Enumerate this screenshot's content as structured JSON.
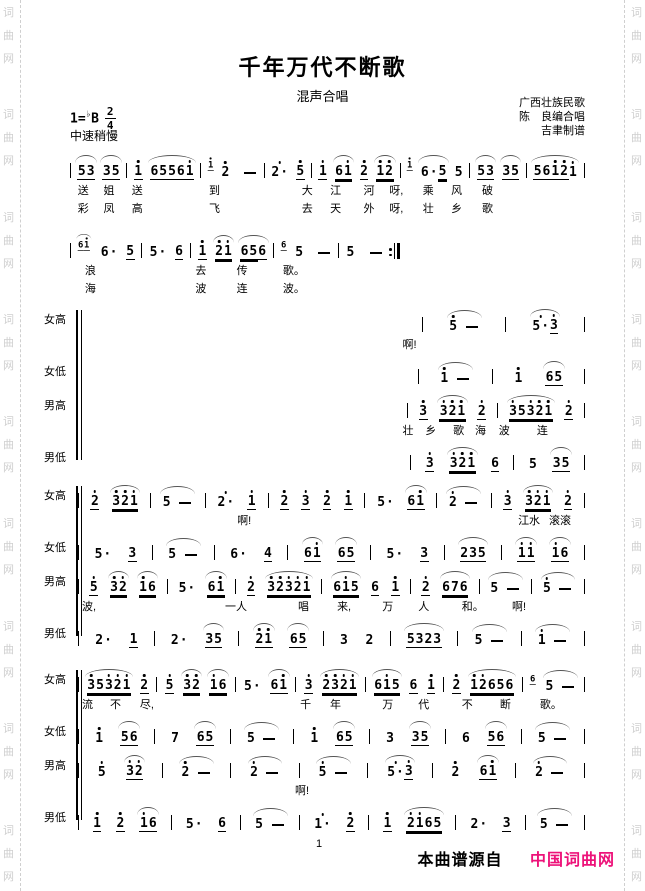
{
  "header": {
    "title": "千年万代不断歌",
    "subtitle": "混声合唱",
    "key_prefix": "1=",
    "key_flat": "♭",
    "key_note": "B",
    "meter_num": "2",
    "meter_den": "4",
    "tempo": "中速稍慢",
    "credits": [
      "广西壮族民歌",
      "陈　良编合唱",
      "吉聿制谱"
    ]
  },
  "watermark": {
    "chars": [
      "词",
      "曲",
      "网"
    ],
    "color": "#cfcfcf",
    "groups": 9
  },
  "music": {
    "systems": [
      {
        "id": "system-1",
        "type": "plain",
        "top": 146,
        "left": 70,
        "width": 515,
        "rows": [
          {
            "notes": "| 5_3_ 3_5_ | 1'_ 6_5_5_6_1'_ | (1'_) 2' - | 2'* 5'_ | 1'_ 6=1'= 2'_ 1'=2'= | (1'_) 6*5= 5 | 5_3_ 3_5_ | 5_6_1'_2'_1' |"
          },
          {
            "words": [
              [
                "送",
                1.5
              ],
              [
                "姐",
                6.5
              ],
              [
                "送",
                12
              ],
              [
                "到",
                27
              ],
              [
                "大",
                45
              ],
              [
                "江",
                50.5
              ],
              [
                "河",
                57
              ],
              [
                "呀,",
                62
              ],
              [
                "乘",
                68.5
              ],
              [
                "风",
                74
              ],
              [
                "破",
                80
              ]
            ]
          },
          {
            "words": [
              [
                "彩",
                1.5
              ],
              [
                "凤",
                6.5
              ],
              [
                "高",
                12
              ],
              [
                "飞",
                27
              ],
              [
                "去",
                45
              ],
              [
                "天",
                50.5
              ],
              [
                "外",
                57
              ],
              [
                "呀,",
                62
              ],
              [
                "壮",
                68.5
              ],
              [
                "乡",
                74
              ],
              [
                "歌",
                80
              ]
            ]
          }
        ]
      },
      {
        "id": "system-2",
        "type": "plain",
        "top": 226,
        "left": 70,
        "width": 330,
        "rows": [
          {
            "notes": "| (6_1'_) 6* 5_ | 5* 6_ | 1'_ 2'=1'= 6=5=6_ | (6_) 5 - | 5 - :|"
          },
          {
            "words": [
              [
                "浪",
                4.5
              ],
              [
                "去",
                38
              ],
              [
                "传",
                50.5
              ],
              [
                "歌。",
                64.5
              ]
            ]
          },
          {
            "words": [
              [
                "海",
                4.5
              ],
              [
                "波",
                38
              ],
              [
                "连",
                50.5
              ],
              [
                "波。",
                64.5
              ]
            ]
          }
        ]
      },
      {
        "id": "system-3",
        "type": "choral",
        "top": 300,
        "left": 44,
        "width": 541,
        "rows": [
          {
            "label": "女高",
            "notes": "| 5'- | 5'*3'_ |",
            "offset": 63
          },
          {
            "words": [
              [
                "啊!",
                64
              ]
            ]
          },
          {
            "label": "女低",
            "notes": "| 1'- | 1' 6_5_ |",
            "offset": 63
          },
          {
            "label": "男高",
            "notes": "| 3'_ 3'=2'=1'= 2'_ | 3'=5=3'=2'=1'= 2'_ |",
            "offset": 63
          },
          {
            "words": [
              [
                "壮",
                64
              ],
              [
                "乡",
                68.5
              ],
              [
                "歌",
                74
              ],
              [
                "海",
                78.3
              ],
              [
                "波",
                83
              ],
              [
                "连",
                90.5
              ]
            ]
          },
          {
            "label": "男低",
            "notes": "| 3'_ 3'=2'=1'= 6_ | 5 3_5_ |",
            "offset": 63
          }
        ]
      },
      {
        "id": "system-4",
        "type": "choral",
        "top": 476,
        "left": 44,
        "width": 541,
        "rows": [
          {
            "label": "女高",
            "notes": "| 2'_ 3'=2'=1'= | 5- | 2'* 1'_ | 2'_ 3'_ 2'_ 1'_ | 5* 6_1'_ | 2'- | 3'_ 3'=2'=1'= 2'_ |"
          },
          {
            "words": [
              [
                "啊!",
                31.4
              ],
              [
                "江水",
                86.8
              ],
              [
                "滚滚",
                92.9
              ]
            ]
          },
          {
            "label": "女低",
            "notes": "| 5* 3_ | 5- | 6* 4_ | 6_1'_ 6_5_ | 5* 3_ | 2_3_5_ | 1'_1'_ 1'_6_ |"
          },
          {
            "label": "男高",
            "notes": "| 5'_ 3'=2'= 1'=6= | 5* 6=1'= | 2'_ 3'=2'=3'=2'=1'= | 6=1'=5= 6_ 1'_ | 2'_ 6=7=6= | 5- | 5'- |"
          },
          {
            "words": [
              [
                "波,",
                0.8
              ],
              [
                "一人",
                29
              ],
              [
                "唱",
                43.4
              ],
              [
                "来,",
                51.1
              ],
              [
                "万",
                60
              ],
              [
                "人",
                67.1
              ],
              [
                "和。",
                75.7
              ],
              [
                "啊!",
                85.6
              ]
            ]
          },
          {
            "label": "男低",
            "notes": "| 2* 1_ | 2* 3_5_ | 2'_1'_ 6_5_ | 3 2 | 5_3_2_3_ | 5- | 1'- |"
          }
        ]
      },
      {
        "id": "system-5",
        "type": "choral",
        "top": 660,
        "left": 44,
        "width": 541,
        "rows": [
          {
            "label": "女高",
            "notes": "| 3'=5=3'=2'=1'= 2'_ | 5'_ 3'=2'= 1'=6= | 5* 6_1'_ | 3'_ 2'=3'=2'=1'= | 6=1'=5= 6_ 1'_ | 2'_ 1'=2'=6=5=6= | (6_) 5- |"
          },
          {
            "words": [
              [
                "流",
                0.8
              ],
              [
                "不",
                6.3
              ],
              [
                "尽,",
                12.2
              ],
              [
                "千",
                43.8
              ],
              [
                "年",
                49.7
              ],
              [
                "万",
                60
              ],
              [
                "代",
                67.1
              ],
              [
                "不",
                75.7
              ],
              [
                "断",
                83.2
              ],
              [
                "歌。",
                91.1
              ]
            ]
          },
          {
            "label": "女低",
            "notes": "| 1' 5_6_ | 7 6_5_ | 5- | 1' 6_5_ | 3 3_5_ | 6 5_6_ | 5- |"
          },
          {
            "label": "男高",
            "notes": "| 5' 3'_2'_ | 2'- | 2'- | 5'- | 5'*3'_ | 2' 6_1'_ | 2'- |"
          },
          {
            "words": [
              [
                "啊!",
                42.8
              ]
            ]
          },
          {
            "label": "男低",
            "notes": "| 1'_ 2'_ 1'_6_ | 5* 6_ | 5- | 1'* 2'_ | 1'_ 2'=1'=6=5= | 2* 3_ | 5- |"
          }
        ]
      }
    ]
  },
  "footer": {
    "page_number": "1",
    "source_prefix": "本曲谱源自",
    "source_name": "中国词曲网",
    "source_color": "#ed1279"
  }
}
